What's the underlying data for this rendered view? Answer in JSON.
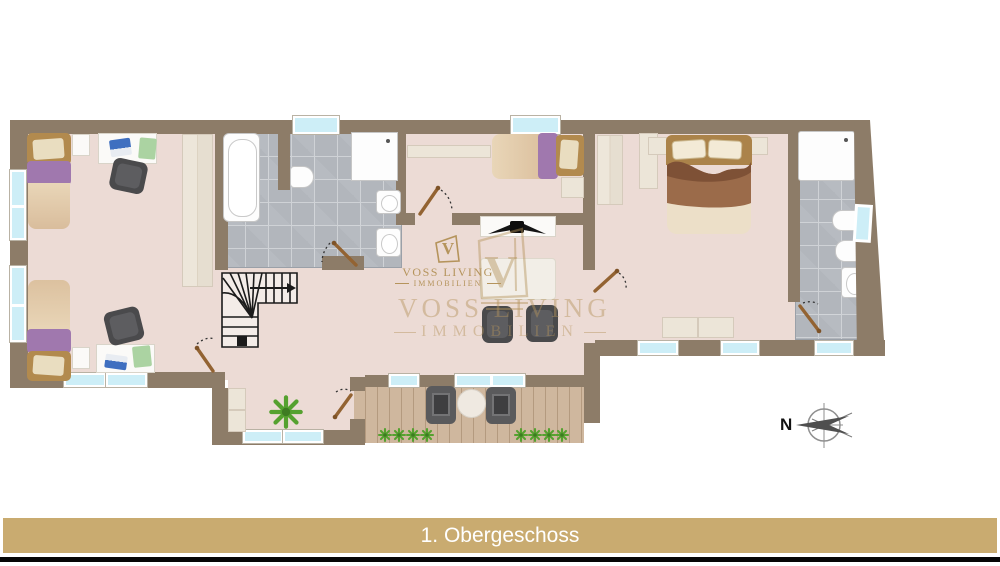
{
  "banner": {
    "title": "1. Obergeschoss",
    "background": "#c9ab70",
    "text_color": "#ffffff"
  },
  "compass": {
    "north_label": "N"
  },
  "brand_watermark": {
    "monogram": "V",
    "name": "VOSS LIVING",
    "subtitle": "IMMOBILIEN",
    "color": "#b5945c"
  },
  "brand_watermark_large": {
    "monogram": "V",
    "name": "VOSS LIVING",
    "subtitle": "IMMOBILIEN"
  },
  "palette": {
    "wall": "#8d7c68",
    "floor": "#ecdbd5",
    "tile": "#b2b6bc",
    "deck": "#cfb79e",
    "window_glass": "#cdeef7",
    "accent_gold": "#c9ab70",
    "logo_gold": "#b5945c",
    "furniture_dark": "#4a4a4c",
    "bed_purple": "#a078ae",
    "wood": "#b28a4e",
    "plant_green": "#55a12f"
  }
}
